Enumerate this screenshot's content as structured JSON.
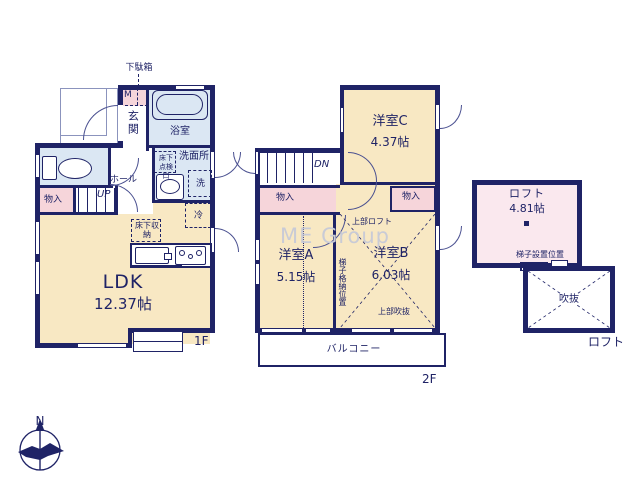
{
  "watermark": "ME Group",
  "compass": {
    "north_label": "N"
  },
  "palette": {
    "wall": "#1f2366",
    "room_cream": "#f8e8c3",
    "wet_blue": "#dbe7f3",
    "storage_pink": "#f6d5da",
    "loft_pink": "#fae8ee"
  },
  "floor1": {
    "floor_label": "1F",
    "shoe_cabinet": "下駄箱",
    "meter_box": "M",
    "genkan": "玄関",
    "bathroom": "浴室",
    "washroom": "洗面所",
    "underfloor_hatch": "床下点検口",
    "washer": "洗",
    "storage": "物入",
    "hall": "ホール",
    "stairs_up": "UP",
    "fridge": "冷",
    "underfloor_storage": "床下収納",
    "ldk": {
      "name": "LDK",
      "size": "12.37帖"
    }
  },
  "floor2": {
    "floor_label": "2F",
    "stairs_down": "DN",
    "room_c": {
      "name": "洋室C",
      "size": "4.37帖"
    },
    "storage_left": "物入",
    "storage_right": "物入",
    "upper_loft": "上部ロフト",
    "room_a": {
      "name": "洋室A",
      "size": "5.15帖"
    },
    "ladder_storage": "梯子格納位置",
    "room_b": {
      "name": "洋室B",
      "size": "6.03帖"
    },
    "upper_void": "上部吹抜",
    "balcony": "バルコニー"
  },
  "loft": {
    "floor_label": "ロフト",
    "room": {
      "name": "ロフト",
      "size": "4.81帖"
    },
    "ladder_position": "梯子設置位置",
    "void": "吹抜"
  }
}
